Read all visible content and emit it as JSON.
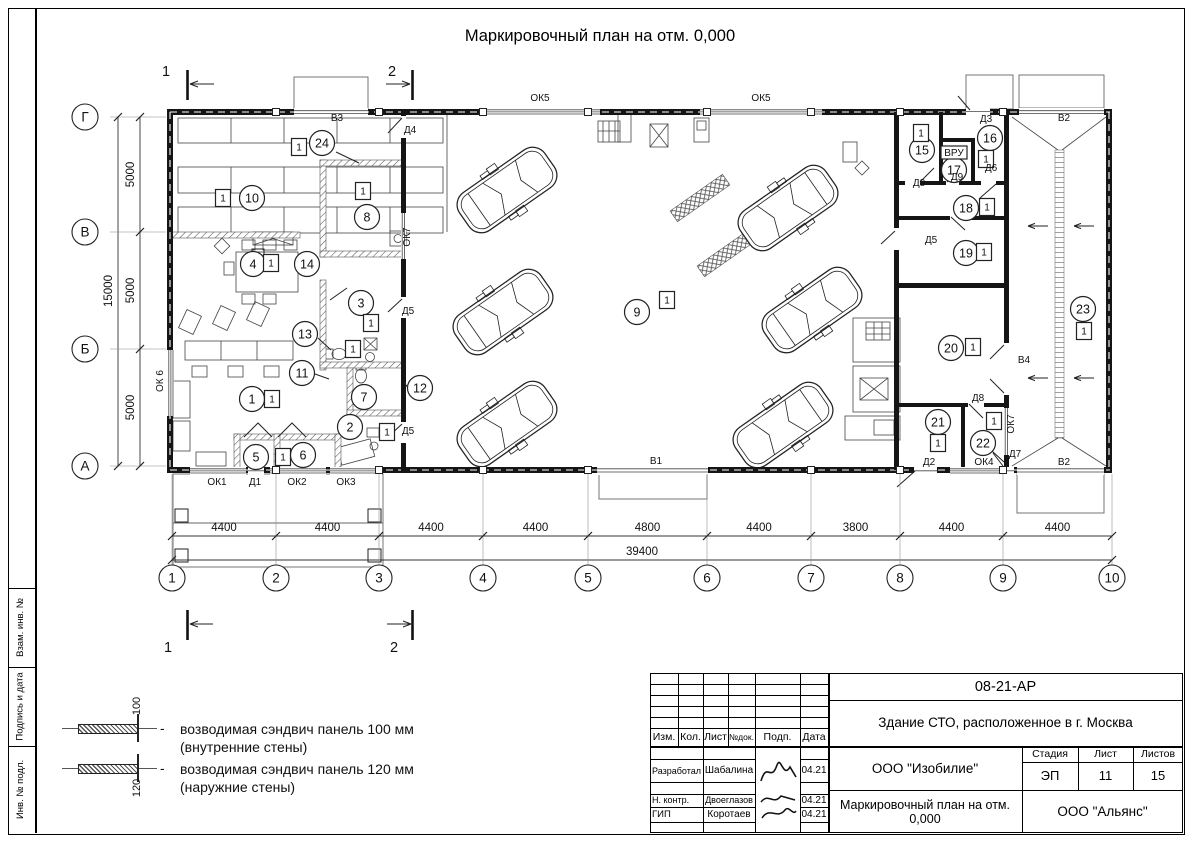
{
  "sheet_title": "Маркировочный план на отм. 0,000",
  "side_strip": {
    "cells": [
      "Взам. инв. №",
      "Подпись и дата",
      "Инв. № подл."
    ]
  },
  "legend": {
    "separator": "-",
    "items": [
      {
        "dim": "100",
        "line1": "возводимая сэндвич панель 100 мм",
        "line2": "(внутренние стены)"
      },
      {
        "dim": "120",
        "line1": "возводимая сэндвич панель 120 мм",
        "line2": "(наружние стены)"
      }
    ]
  },
  "plan": {
    "section_marks": {
      "s1": "1",
      "s2": "2"
    },
    "axes": {
      "cols": [
        "1",
        "2",
        "3",
        "4",
        "5",
        "6",
        "7",
        "8",
        "9",
        "10"
      ],
      "rows": [
        "Г",
        "В",
        "Б",
        "А"
      ]
    },
    "dimensions": {
      "bottom": [
        "4400",
        "4400",
        "4400",
        "4400",
        "4800",
        "4400",
        "3800",
        "4400",
        "4400"
      ],
      "bottom_total": "39400",
      "left": [
        "5000",
        "5000",
        "5000"
      ],
      "left_total": "15000"
    },
    "rooms": [
      {
        "n": "1",
        "x": 252,
        "y": 399,
        "badge": "1",
        "bx": 272,
        "by": 399
      },
      {
        "n": "2",
        "x": 350,
        "y": 427,
        "badge": "1",
        "bx": 387,
        "by": 432
      },
      {
        "n": "3",
        "x": 361,
        "y": 303,
        "badge": "1",
        "bx": 371,
        "by": 323
      },
      {
        "n": "4",
        "x": 253,
        "y": 264,
        "badge": "1",
        "bx": 271,
        "by": 263
      },
      {
        "n": "5",
        "x": 256,
        "y": 457,
        "badge": "1",
        "bx": 283,
        "by": 457
      },
      {
        "n": "6",
        "x": 303,
        "y": 455
      },
      {
        "n": "7",
        "x": 364,
        "y": 397
      },
      {
        "n": "8",
        "x": 367,
        "y": 217,
        "badge": "1",
        "bx": 363,
        "by": 191
      },
      {
        "n": "9",
        "x": 637,
        "y": 312,
        "badge": "1",
        "bx": 667,
        "by": 300
      },
      {
        "n": "10",
        "x": 252,
        "y": 198,
        "badge": "1",
        "bx": 223,
        "by": 198
      },
      {
        "n": "11",
        "x": 302,
        "y": 373
      },
      {
        "n": "12",
        "x": 420,
        "y": 388
      },
      {
        "n": "13",
        "x": 305,
        "y": 334,
        "badge": "1",
        "bx": 353,
        "by": 349
      },
      {
        "n": "14",
        "x": 307,
        "y": 264
      },
      {
        "n": "15",
        "x": 922,
        "y": 150,
        "badge": "1",
        "bx": 921,
        "by": 133
      },
      {
        "n": "16",
        "x": 990,
        "y": 138,
        "badge": "1",
        "bx": 986,
        "by": 159
      },
      {
        "n": "17",
        "x": 954,
        "y": 170
      },
      {
        "n": "18",
        "x": 966,
        "y": 208,
        "badge": "1",
        "bx": 987,
        "by": 207
      },
      {
        "n": "19",
        "x": 966,
        "y": 253,
        "badge": "1",
        "bx": 984,
        "by": 252
      },
      {
        "n": "20",
        "x": 951,
        "y": 348,
        "badge": "1",
        "bx": 973,
        "by": 347
      },
      {
        "n": "21",
        "x": 938,
        "y": 422,
        "badge": "1",
        "bx": 938,
        "by": 443
      },
      {
        "n": "22",
        "x": 983,
        "y": 443,
        "badge": "1",
        "bx": 994,
        "by": 421
      },
      {
        "n": "23",
        "x": 1083,
        "y": 309,
        "badge": "1",
        "bx": 1084,
        "by": 331
      },
      {
        "n": "24",
        "x": 322,
        "y": 143,
        "badge": "1",
        "bx": 299,
        "by": 147
      }
    ],
    "openings": [
      {
        "t": "В3",
        "x": 337,
        "y": 121
      },
      {
        "t": "Д4",
        "x": 410,
        "y": 133
      },
      {
        "t": "ОК5",
        "x": 540,
        "y": 101
      },
      {
        "t": "ОК5",
        "x": 761,
        "y": 101
      },
      {
        "t": "Д3",
        "x": 986,
        "y": 122
      },
      {
        "t": "В2",
        "x": 1064,
        "y": 121
      },
      {
        "t": "ОК 6",
        "x": 163,
        "y": 381,
        "rot": -90
      },
      {
        "t": "ОК7",
        "x": 410,
        "y": 237,
        "rot": -90
      },
      {
        "t": "Д5",
        "x": 408,
        "y": 314
      },
      {
        "t": "Д5",
        "x": 408,
        "y": 434
      },
      {
        "t": "ОК1",
        "x": 217,
        "y": 485
      },
      {
        "t": "Д1",
        "x": 255,
        "y": 485
      },
      {
        "t": "ОК2",
        "x": 297,
        "y": 485
      },
      {
        "t": "ОК3",
        "x": 346,
        "y": 485
      },
      {
        "t": "В1",
        "x": 656,
        "y": 464
      },
      {
        "t": "Д2",
        "x": 929,
        "y": 465
      },
      {
        "t": "ОК4",
        "x": 984,
        "y": 465
      },
      {
        "t": "Д7",
        "x": 1015,
        "y": 457
      },
      {
        "t": "В2",
        "x": 1064,
        "y": 465
      },
      {
        "t": "Д8",
        "x": 919,
        "y": 186
      },
      {
        "t": "Д9",
        "x": 957,
        "y": 180
      },
      {
        "t": "Д6",
        "x": 991,
        "y": 171
      },
      {
        "t": "ВРУ",
        "x": 954,
        "y": 156,
        "box": true
      },
      {
        "t": "Д5",
        "x": 931,
        "y": 243
      },
      {
        "t": "Д8",
        "x": 978,
        "y": 401
      },
      {
        "t": "ОК7",
        "x": 1014,
        "y": 424,
        "rot": -90
      },
      {
        "t": "В4",
        "x": 1024,
        "y": 363
      }
    ]
  },
  "title_block": {
    "doc_number": "08-21-АР",
    "project": "Здание СТО, расположенное в г. Москва",
    "columns": [
      "Изм.",
      "Кол.",
      "Лист",
      "№док.",
      "Подп.",
      "Дата"
    ],
    "rows": [
      {
        "role": "Разработал",
        "name": "Шабалина",
        "date": "04.21"
      },
      {
        "role": "Н. контр.",
        "name": "Двоеглазов",
        "date": "04.21"
      },
      {
        "role": "ГИП",
        "name": "Коротаев",
        "date": "04.21"
      }
    ],
    "company": "ООО \"Изобилие\"",
    "stage_label": "Стадия",
    "sheet_label": "Лист",
    "sheets_label": "Листов",
    "stage": "ЭП",
    "sheet": "11",
    "sheets": "15",
    "drawing_title": "Маркировочный план на отм. 0,000",
    "contractor": "ООО \"Альянс\""
  }
}
